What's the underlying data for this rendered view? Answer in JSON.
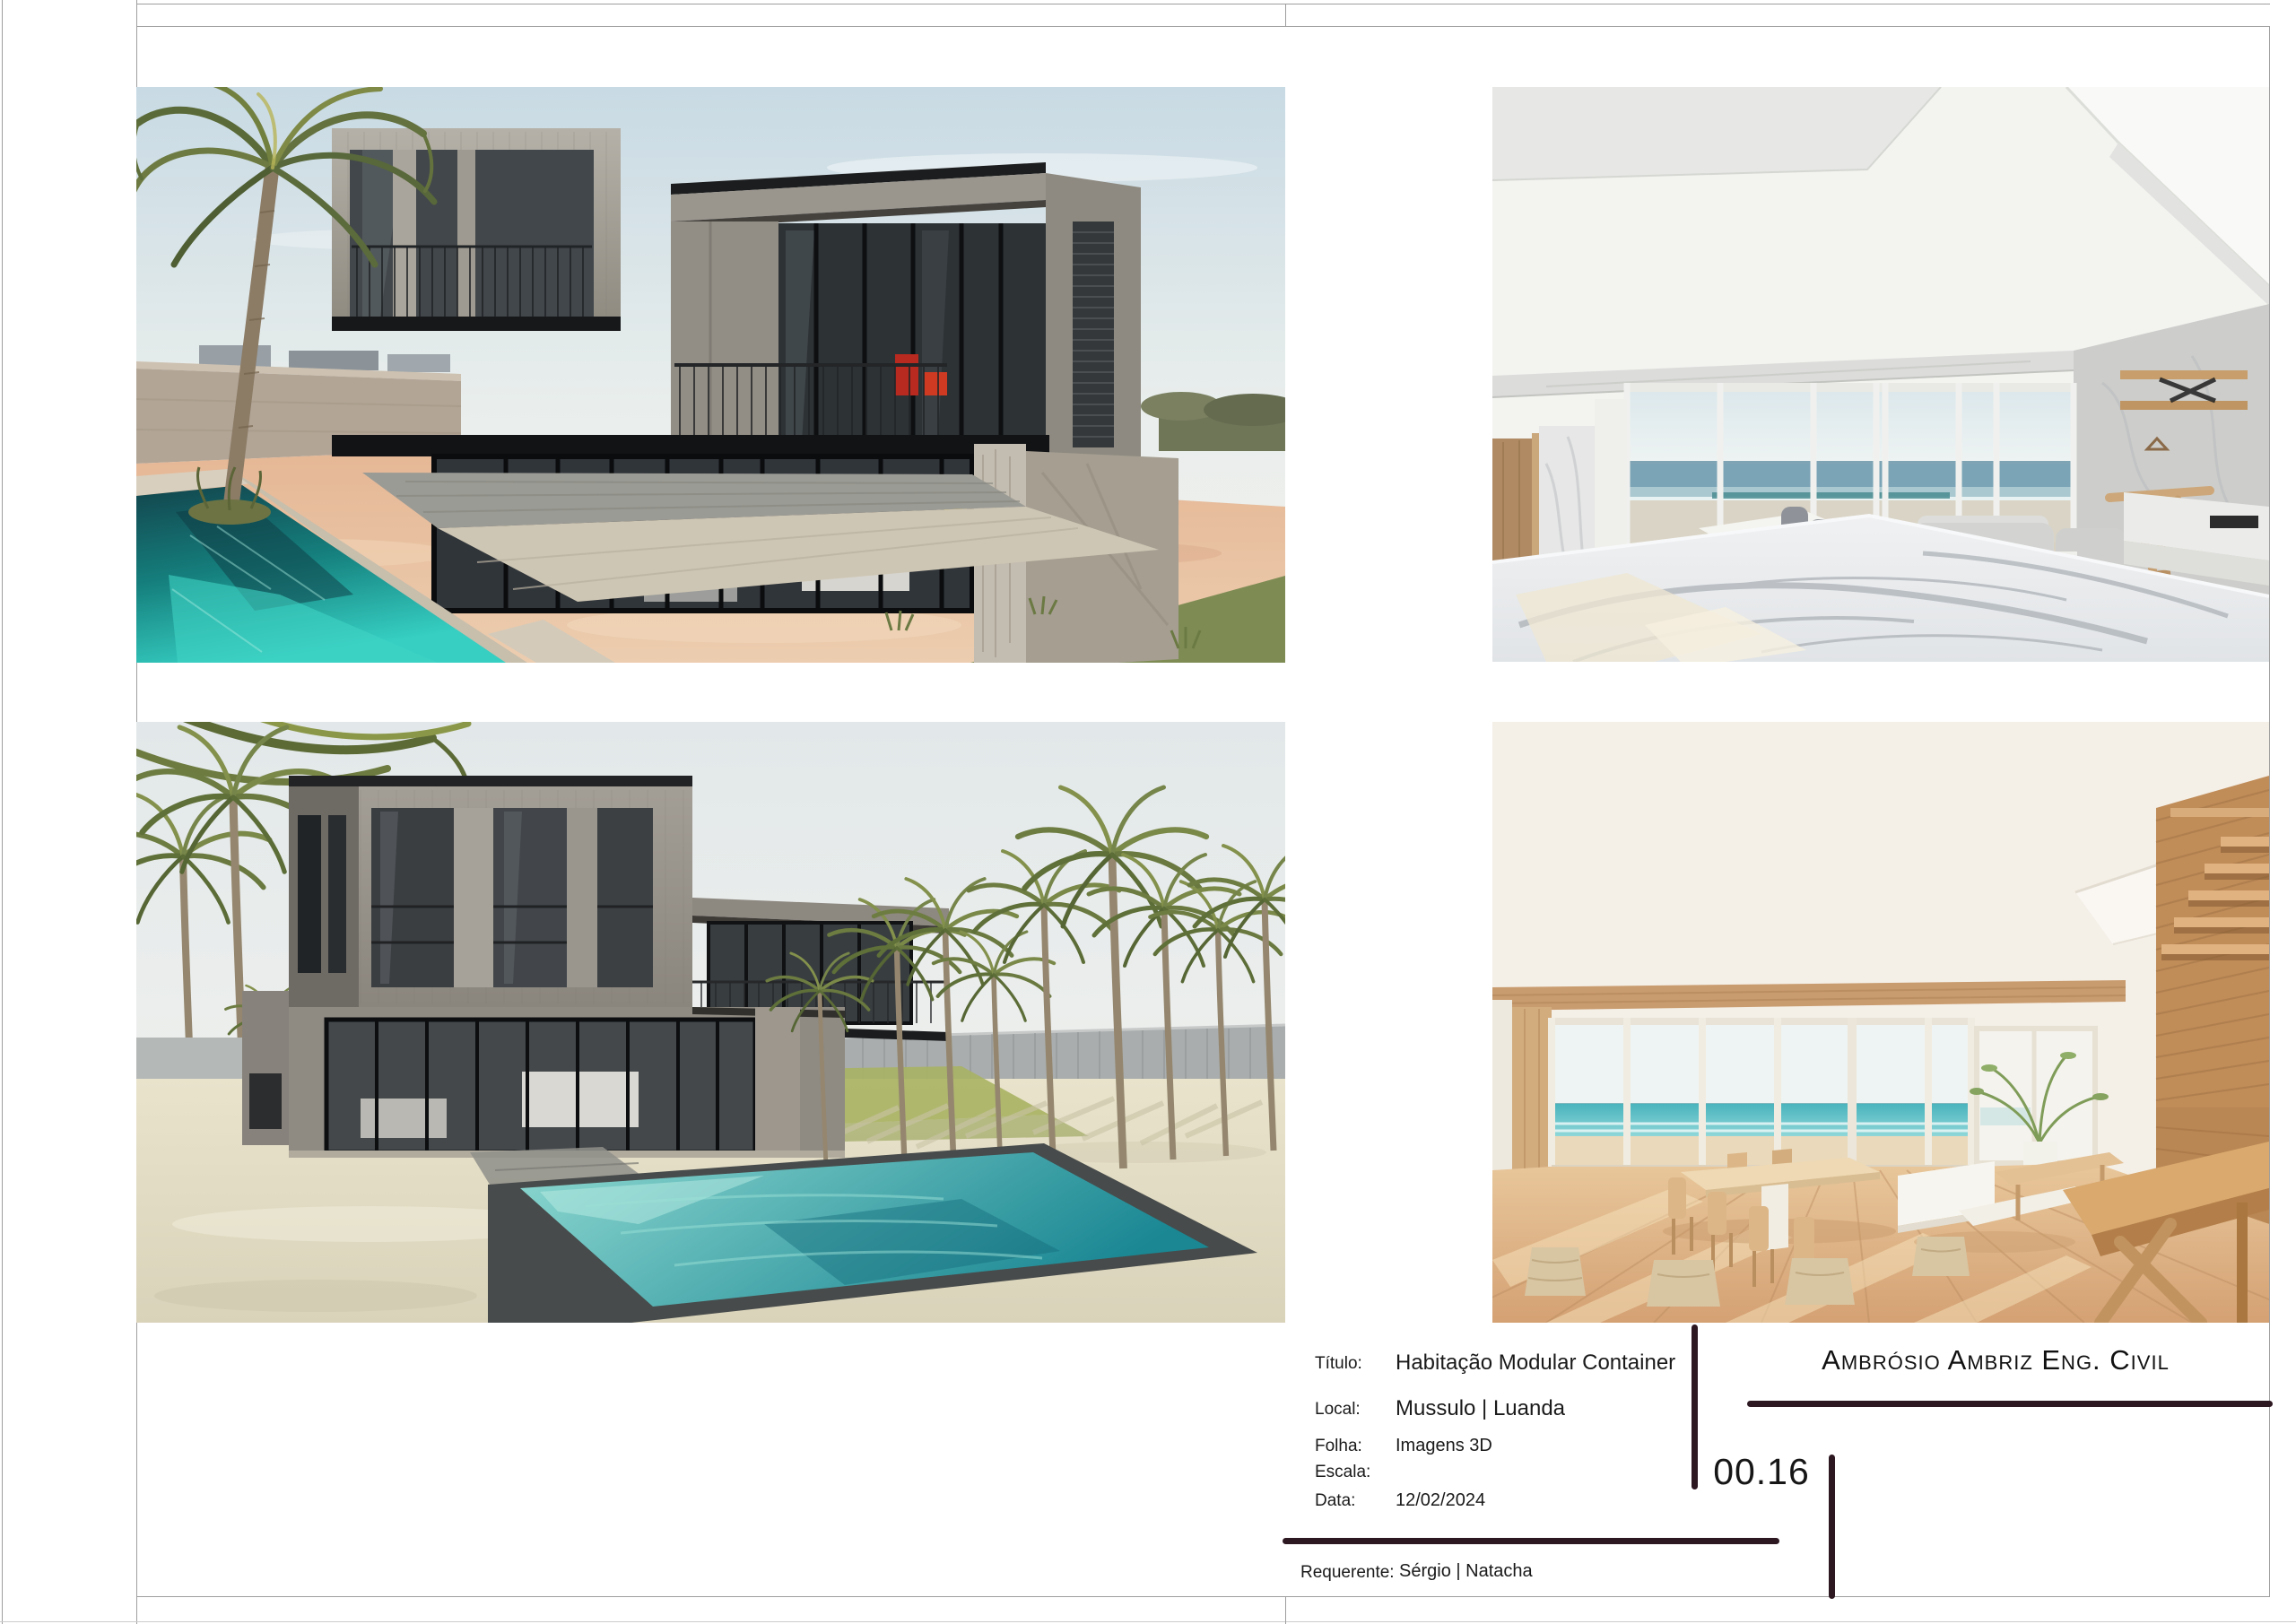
{
  "colors": {
    "accent_line": "#2d1721",
    "frame_line": "#9e9e9e",
    "text": "#1a1a1a",
    "pool_water": "#36cfc2",
    "sand": "#e5b795"
  },
  "title_block": {
    "fields": {
      "titulo": {
        "label": "Título:",
        "value": "Habitação Modular Container"
      },
      "local": {
        "label": "Local:",
        "value": "Mussulo | Luanda"
      },
      "folha": {
        "label": "Folha:",
        "value": "Imagens 3D"
      },
      "escala": {
        "label": "Escala:",
        "value": ""
      },
      "data": {
        "label": "Data:",
        "value": "12/02/2024"
      },
      "requerente": {
        "label": "Requerente:",
        "value": "Sérgio | Natacha"
      }
    },
    "sheet_number": "00.16",
    "company_name": "Ambrósio Ambriz Eng. Civil"
  }
}
